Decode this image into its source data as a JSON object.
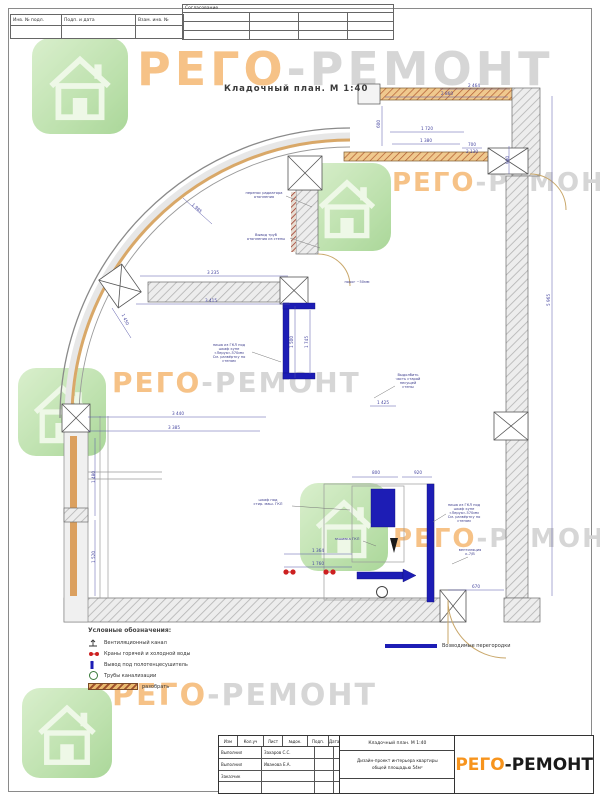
{
  "page": {
    "drawing_title": "Кладочный план. М 1:40"
  },
  "top_stamp": {
    "approval_header": "Согласование",
    "fields": [
      {
        "label": "Инв. № подл."
      },
      {
        "label": "Подп. и дата"
      },
      {
        "label": "Взам. инв. №"
      }
    ]
  },
  "watermark": {
    "brand_part1": "РЕГО",
    "brand_part2": "-РЕМОНТ"
  },
  "legend": {
    "title": "Условные обозначения:",
    "items": [
      {
        "label": "Вентиляционный канал"
      },
      {
        "label": "Краны горячей и холодной воды"
      },
      {
        "label": "Вывод под полотенцесушитель"
      },
      {
        "label": "Трубы канализации"
      },
      {
        "label": "разобрать"
      }
    ],
    "right_items": [
      {
        "label": "Возводимые перегородки"
      }
    ]
  },
  "title_block": {
    "header_cols": [
      "Изм",
      "Кол.уч",
      "Лист",
      "№док.",
      "Подп.",
      "Дата"
    ],
    "rows": [
      {
        "role": "Выполнил",
        "name": "Захаров С.С."
      },
      {
        "role": "Выполнил",
        "name": "Иванова Е.А."
      },
      {
        "role": "Заказчик",
        "name": ""
      }
    ],
    "doc_title": "Кладочный план. М 1:40",
    "project_line1": "Дизайн-проект интерьера квартиры",
    "project_line2": "общей площадью 54м²",
    "brand_part1": "РЕГО",
    "brand_part2": "-РЕМОНТ"
  },
  "plan": {
    "dimensions": [
      {
        "x": 474,
        "y": 87,
        "t": "2 464"
      },
      {
        "x": 447,
        "y": 95,
        "t": "2 860"
      },
      {
        "x": 427,
        "y": 130,
        "t": "1 720"
      },
      {
        "x": 426,
        "y": 142,
        "t": "1 380"
      },
      {
        "x": 472,
        "y": 146,
        "t": "700"
      },
      {
        "x": 472,
        "y": 153,
        "t": "2 130"
      },
      {
        "x": 380,
        "y": 124,
        "t": "600",
        "r": -90
      },
      {
        "x": 509,
        "y": 160,
        "t": "980",
        "r": -90
      },
      {
        "x": 196,
        "y": 209,
        "t": "1 985",
        "r": 42
      },
      {
        "x": 124,
        "y": 320,
        "t": "1 450",
        "r": 66
      },
      {
        "x": 213,
        "y": 274,
        "t": "3 235"
      },
      {
        "x": 211,
        "y": 302,
        "t": "3 415"
      },
      {
        "x": 178,
        "y": 415,
        "t": "3 440"
      },
      {
        "x": 174,
        "y": 429,
        "t": "3 385"
      },
      {
        "x": 293,
        "y": 342,
        "t": "1 500",
        "r": -90
      },
      {
        "x": 308,
        "y": 342,
        "t": "1 745",
        "r": -90
      },
      {
        "x": 95,
        "y": 477,
        "t": "1 480",
        "r": -90
      },
      {
        "x": 95,
        "y": 557,
        "t": "1 520",
        "r": -90
      },
      {
        "x": 550,
        "y": 300,
        "t": "5 965",
        "r": -90
      },
      {
        "x": 376,
        "y": 474,
        "t": "800"
      },
      {
        "x": 418,
        "y": 474,
        "t": "920"
      },
      {
        "x": 318,
        "y": 552,
        "t": "1 364"
      },
      {
        "x": 318,
        "y": 565,
        "t": "1 760"
      },
      {
        "x": 476,
        "y": 588,
        "t": "670"
      },
      {
        "x": 383,
        "y": 404,
        "t": "1 425"
      }
    ],
    "annotations": [
      {
        "x": 264,
        "y": 194,
        "t": "перенос радиатора\nотопления"
      },
      {
        "x": 266,
        "y": 236,
        "t": "Вывод труб\nотопления из стены"
      },
      {
        "x": 357,
        "y": 283,
        "t": "порог ~50мм",
        "c": "#b5651d"
      },
      {
        "x": 229,
        "y": 346,
        "t": "ниша из ГКЛ под\nшкаф купе\n«Леруа»-570мм\nСм. развёртку по\nстенам"
      },
      {
        "x": 408,
        "y": 376,
        "t": "Выдолбить\nчасть старой\nнесущей\nстены",
        "c": "#444444"
      },
      {
        "x": 268,
        "y": 501,
        "t": "шкаф под\nстир. маш. ГКЛ"
      },
      {
        "x": 347,
        "y": 540,
        "t": "зашивка ГКЛ"
      },
      {
        "x": 464,
        "y": 506,
        "t": "ниша из ГКЛ под\nшкаф купе\n«Леруа»-570мм\nСм. развёртку по\nстенам"
      },
      {
        "x": 470,
        "y": 551,
        "t": "вентиляция\nк-7/В"
      }
    ]
  }
}
